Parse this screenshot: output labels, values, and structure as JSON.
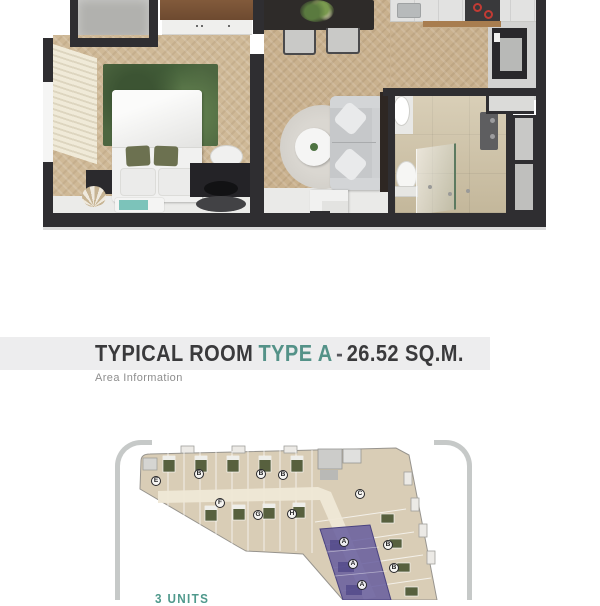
{
  "header": {
    "title_room": "TYPICAL ROOM",
    "title_type": "TYPE A",
    "title_dash": "-",
    "title_area": "26.52 SQ.M.",
    "subtitle": "Area Information"
  },
  "colors": {
    "accent_teal": "#549288",
    "title_dark": "#3a3a3c",
    "band_gray": "#ededee",
    "wall_dark": "#2f2e31",
    "highlight_purple": "#655c9e",
    "bracket_gray": "#c6c9c8"
  },
  "floorplan": {
    "areas": [
      "balcony",
      "bedroom",
      "living-dining",
      "kitchen",
      "bathroom",
      "entry"
    ]
  },
  "floorplate": {
    "units_count_label": "3 UNITS",
    "unit_labels": [
      "E",
      "B",
      "B",
      "B",
      "F",
      "G",
      "H",
      "C",
      "A",
      "A",
      "A",
      "B",
      "B"
    ]
  }
}
